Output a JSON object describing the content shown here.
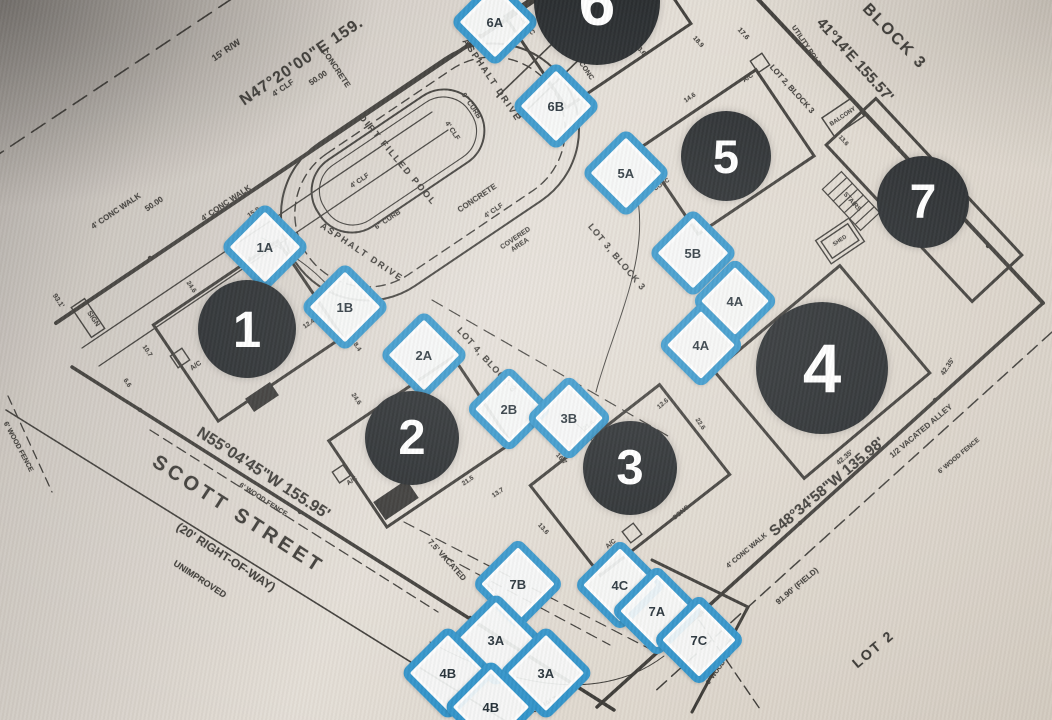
{
  "photo": {
    "colors": {
      "blue": "#2a90c8",
      "circle": "#1b1f22",
      "circle_text": "#ffffff",
      "ink": "#35332f"
    }
  },
  "circles": [
    {
      "label": "1",
      "x": 247,
      "y": 329,
      "r": 49
    },
    {
      "label": "2",
      "x": 412,
      "y": 438,
      "r": 47
    },
    {
      "label": "3",
      "x": 630,
      "y": 468,
      "r": 47
    },
    {
      "label": "4",
      "x": 822,
      "y": 368,
      "r": 66
    },
    {
      "label": "5",
      "x": 726,
      "y": 156,
      "r": 45
    },
    {
      "label": "6",
      "x": 597,
      "y": 2,
      "r": 63
    },
    {
      "label": "7",
      "x": 923,
      "y": 202,
      "r": 46
    }
  ],
  "markers": [
    {
      "label": "1A",
      "x": 258,
      "y": 240,
      "s": 50
    },
    {
      "label": "1B",
      "x": 338,
      "y": 300,
      "s": 50
    },
    {
      "label": "2A",
      "x": 417,
      "y": 348,
      "s": 50
    },
    {
      "label": "2B",
      "x": 502,
      "y": 402,
      "s": 48
    },
    {
      "label": "3B",
      "x": 562,
      "y": 411,
      "s": 48
    },
    {
      "label": "5A",
      "x": 619,
      "y": 166,
      "s": 50
    },
    {
      "label": "5B",
      "x": 686,
      "y": 246,
      "s": 50
    },
    {
      "label": "4A",
      "x": 728,
      "y": 294,
      "s": 48
    },
    {
      "label": "4A",
      "x": 694,
      "y": 338,
      "s": 48
    },
    {
      "label": "6A",
      "x": 488,
      "y": 15,
      "s": 50
    },
    {
      "label": "6B",
      "x": 549,
      "y": 99,
      "s": 50
    },
    {
      "label": "7B",
      "x": 511,
      "y": 577,
      "s": 52
    },
    {
      "label": "4C",
      "x": 613,
      "y": 578,
      "s": 52
    },
    {
      "label": "7A",
      "x": 650,
      "y": 604,
      "s": 52
    },
    {
      "label": "7C",
      "x": 692,
      "y": 633,
      "s": 52
    },
    {
      "label": "3A",
      "x": 489,
      "y": 633,
      "s": 54
    },
    {
      "label": "4B",
      "x": 441,
      "y": 666,
      "s": 54
    },
    {
      "label": "3A",
      "x": 539,
      "y": 666,
      "s": 54
    },
    {
      "label": "4B",
      "x": 484,
      "y": 700,
      "s": 54
    }
  ],
  "labels": {
    "bearings": [
      {
        "name": "bearing-northwest",
        "text": "N47°20'00\"E 159.",
        "x": 302,
        "y": 62,
        "rot": -34,
        "size": 16,
        "b": 1,
        "sp": 1
      },
      {
        "name": "bearing-northeast",
        "text": "41°14'E 155.57'",
        "x": 855,
        "y": 60,
        "rot": 48,
        "size": 15,
        "b": 1
      },
      {
        "name": "bearing-southwest",
        "text": "N55°04'45\"W 155.95'",
        "x": 263,
        "y": 474,
        "rot": 33,
        "size": 16,
        "b": 1
      },
      {
        "name": "bearing-southeast",
        "text": "S48°34'58\"W 135.98'",
        "x": 827,
        "y": 487,
        "rot": -40,
        "size": 15,
        "b": 1
      },
      {
        "name": "field-distance",
        "text": "91.90' (FIELD)",
        "x": 797,
        "y": 586,
        "rot": -40,
        "size": 8
      },
      {
        "name": "right-of-way-note",
        "text": "15' R/W",
        "x": 226,
        "y": 50,
        "rot": -34,
        "size": 9,
        "b": 1
      }
    ],
    "lots": [
      {
        "name": "block3-title",
        "text": "BLOCK 3",
        "x": 894,
        "y": 37,
        "rot": 46,
        "size": 16,
        "b": 1,
        "sp": 2
      },
      {
        "name": "lot2-block3",
        "text": "LOT 2, BLOCK 3",
        "x": 792,
        "y": 89,
        "rot": 48,
        "size": 8
      },
      {
        "name": "lot3-block3",
        "text": "LOT 3, BLOCK 3",
        "x": 617,
        "y": 257,
        "rot": 50,
        "size": 9,
        "sp": 1
      },
      {
        "name": "lot4-block3",
        "text": "LOT 4, BLOCK 3",
        "x": 487,
        "y": 360,
        "rot": 48,
        "size": 9,
        "sp": 1
      },
      {
        "name": "lot2-title",
        "text": "LOT 2",
        "x": 873,
        "y": 649,
        "rot": -40,
        "size": 14,
        "b": 1,
        "sp": 2
      }
    ],
    "street": [
      {
        "name": "street-name",
        "text": "SCOTT STREET",
        "x": 238,
        "y": 515,
        "rot": 33,
        "size": 20,
        "b": 1,
        "sp": 4
      },
      {
        "name": "street-right-of-way",
        "text": "(20' RIGHT-OF-WAY)",
        "x": 226,
        "y": 557,
        "rot": 33,
        "size": 12
      },
      {
        "name": "street-unimproved",
        "text": "UNIMPROVED",
        "x": 200,
        "y": 579,
        "rot": 33,
        "size": 9
      }
    ],
    "alleys": [
      {
        "name": "half-vacated-alley",
        "text": "1/2 VACATED ALLEY",
        "x": 921,
        "y": 431,
        "rot": -40,
        "size": 8
      },
      {
        "name": "vacated-alley",
        "text": "7.5' VACATED",
        "x": 447,
        "y": 560,
        "rot": 48,
        "size": 8
      },
      {
        "name": "utility-alley",
        "text": "UTILITY ALLEY",
        "x": 501,
        "y": 603,
        "rot": 48,
        "size": 8
      }
    ],
    "features": [
      {
        "name": "pool-label",
        "text": "DIRT FILLED POOL",
        "x": 398,
        "y": 160,
        "rot": 50,
        "size": 9,
        "sp": 2
      },
      {
        "name": "asphalt-drive-top",
        "text": "ASPHALT DRIVE",
        "x": 492,
        "y": 80,
        "rot": 56,
        "size": 9,
        "sp": 2
      },
      {
        "name": "asphalt-drive-mid",
        "text": "ASPHALT DRIVE",
        "x": 362,
        "y": 252,
        "rot": 34,
        "size": 9,
        "sp": 2
      },
      {
        "name": "asphalt-bottom",
        "text": "ASPHALT",
        "x": 543,
        "y": 706,
        "rot": -28,
        "size": 7
      },
      {
        "name": "concrete-top",
        "text": "CONCRETE",
        "x": 336,
        "y": 68,
        "rot": 56,
        "size": 8
      },
      {
        "name": "concrete-mid",
        "text": "CONCRETE",
        "x": 477,
        "y": 198,
        "rot": -34,
        "size": 8
      },
      {
        "name": "covered-area",
        "text": "COVERED AREA",
        "x": 518,
        "y": 242,
        "rot": -34,
        "size": 7,
        "wrap": 42
      },
      {
        "name": "walk-label-1",
        "text": "4' CONC WALK",
        "x": 116,
        "y": 211,
        "rot": -34,
        "size": 8
      },
      {
        "name": "walk-label-2",
        "text": "4' CONC WALK",
        "x": 226,
        "y": 203,
        "rot": -34,
        "size": 8
      },
      {
        "name": "walk-label-3",
        "text": "4' CONC WALK",
        "x": 747,
        "y": 551,
        "rot": -40,
        "size": 7
      },
      {
        "name": "curb-label-1",
        "text": "6\" CURB",
        "x": 471,
        "y": 106,
        "rot": 56,
        "size": 7
      },
      {
        "name": "curb-label-2",
        "text": "6\" CURB",
        "x": 388,
        "y": 220,
        "rot": -34,
        "size": 7
      },
      {
        "name": "clf-label-1",
        "text": "4' CLF",
        "x": 283,
        "y": 88,
        "rot": -34,
        "size": 8
      },
      {
        "name": "clf-label-2",
        "text": "4' CLF",
        "x": 452,
        "y": 131,
        "rot": 56,
        "size": 7
      },
      {
        "name": "clf-label-3",
        "text": "4' CLF",
        "x": 360,
        "y": 181,
        "rot": -34,
        "size": 7
      },
      {
        "name": "clf-label-4",
        "text": "4' CLF",
        "x": 494,
        "y": 211,
        "rot": -34,
        "size": 7
      },
      {
        "name": "conc-label-1",
        "text": "CONC",
        "x": 527,
        "y": 26,
        "rot": 56,
        "size": 7
      },
      {
        "name": "conc-label-2",
        "text": "CONC",
        "x": 586,
        "y": 71,
        "rot": 56,
        "size": 7
      },
      {
        "name": "conc-label-3",
        "text": "CONC",
        "x": 662,
        "y": 185,
        "rot": -34,
        "size": 6
      },
      {
        "name": "conc-label-4",
        "text": "CONC",
        "x": 681,
        "y": 513,
        "rot": -40,
        "size": 6.5
      },
      {
        "name": "utility-pole",
        "text": "UTILITY POLE",
        "x": 806,
        "y": 46,
        "rot": 56,
        "size": 7
      },
      {
        "name": "ac-label-1",
        "text": "A/C",
        "x": 196,
        "y": 366,
        "rot": -34,
        "size": 7
      },
      {
        "name": "ac-label-2",
        "text": "A/C",
        "x": 748,
        "y": 78,
        "rot": -34,
        "size": 6.5
      },
      {
        "name": "ac-label-3",
        "text": "A/C",
        "x": 611,
        "y": 544,
        "rot": -40,
        "size": 6.5
      },
      {
        "name": "ac-label-4",
        "text": "A/C",
        "x": 352,
        "y": 481,
        "rot": -34,
        "size": 6.5
      },
      {
        "name": "sign-label",
        "text": "SIGN",
        "x": 93,
        "y": 319,
        "rot": 56,
        "size": 7
      },
      {
        "name": "balcony-label",
        "text": "BALCONY",
        "x": 843,
        "y": 117,
        "rot": -34,
        "size": 6
      },
      {
        "name": "stairs-label",
        "text": "STAIRS",
        "x": 852,
        "y": 202,
        "rot": 48,
        "size": 6.5
      },
      {
        "name": "shed-label",
        "text": "SHED",
        "x": 840,
        "y": 241,
        "rot": -34,
        "size": 5.5
      },
      {
        "name": "wood-fence-se",
        "text": "6' WOOD FENCE",
        "x": 959,
        "y": 456,
        "rot": -40,
        "size": 6.5
      },
      {
        "name": "wood-fence-s",
        "text": "6' WOOD FENCE",
        "x": 723,
        "y": 663,
        "rot": -54,
        "size": 6.5
      },
      {
        "name": "wood-fence-sw",
        "text": "6' WOOD FENCE",
        "x": 263,
        "y": 500,
        "rot": 33,
        "size": 7
      },
      {
        "name": "wood-fence-w",
        "text": "6' WOOD FENCE",
        "x": 18,
        "y": 447,
        "rot": 62,
        "size": 7
      }
    ],
    "dims": [
      {
        "name": "dim-label",
        "text": "50.00",
        "x": 318,
        "y": 78,
        "rot": -34,
        "size": 8
      },
      {
        "name": "dim-label",
        "text": "50.00",
        "x": 154,
        "y": 204,
        "rot": -34,
        "size": 8
      },
      {
        "name": "dim-label",
        "text": "15.9",
        "x": 254,
        "y": 213,
        "rot": -34,
        "size": 7
      },
      {
        "name": "dim-label",
        "text": "93.1'",
        "x": 58,
        "y": 301,
        "rot": 56,
        "size": 7
      },
      {
        "name": "dim-label",
        "text": "17.6",
        "x": 743,
        "y": 34,
        "rot": 48,
        "size": 7
      },
      {
        "name": "dim-label",
        "text": "13.6",
        "x": 843,
        "y": 141,
        "rot": 48,
        "size": 6
      },
      {
        "name": "dim-label",
        "text": "42.35'",
        "x": 845,
        "y": 458,
        "rot": -40,
        "size": 7
      },
      {
        "name": "dim-label",
        "text": "42.35'",
        "x": 948,
        "y": 367,
        "rot": -56,
        "size": 7
      },
      {
        "name": "dim-label",
        "text": "21.4",
        "x": 246,
        "y": 262,
        "rot": -34,
        "size": 6.5
      },
      {
        "name": "dim-label",
        "text": "24.6",
        "x": 191,
        "y": 287,
        "rot": 56,
        "size": 6.5
      },
      {
        "name": "dim-label",
        "text": "12.4",
        "x": 309,
        "y": 324,
        "rot": -34,
        "size": 6.5
      },
      {
        "name": "dim-label",
        "text": "8.4",
        "x": 357,
        "y": 347,
        "rot": 56,
        "size": 6.5
      },
      {
        "name": "dim-label",
        "text": "10.7",
        "x": 147,
        "y": 351,
        "rot": 56,
        "size": 6.5
      },
      {
        "name": "dim-label",
        "text": "6.6",
        "x": 127,
        "y": 383,
        "rot": 56,
        "size": 6.5
      },
      {
        "name": "dim-label",
        "text": "24.6",
        "x": 356,
        "y": 399,
        "rot": 56,
        "size": 6.5
      },
      {
        "name": "dim-label",
        "text": "21.5",
        "x": 468,
        "y": 481,
        "rot": -34,
        "size": 6.5
      },
      {
        "name": "dim-label",
        "text": "13.7",
        "x": 498,
        "y": 493,
        "rot": -34,
        "size": 6.5
      },
      {
        "name": "dim-label",
        "text": "21.6",
        "x": 589,
        "y": 426,
        "rot": -34,
        "size": 6.5
      },
      {
        "name": "dim-label",
        "text": "12.9",
        "x": 603,
        "y": 446,
        "rot": 48,
        "size": 6.5
      },
      {
        "name": "dim-label",
        "text": "16.7",
        "x": 561,
        "y": 459,
        "rot": 48,
        "size": 6.5
      },
      {
        "name": "dim-label",
        "text": "13.6",
        "x": 543,
        "y": 529,
        "rot": 48,
        "size": 6.5
      },
      {
        "name": "dim-label",
        "text": "23.6",
        "x": 640,
        "y": 50,
        "rot": 48,
        "size": 6.5
      },
      {
        "name": "dim-label",
        "text": "18.9",
        "x": 698,
        "y": 42,
        "rot": 48,
        "size": 6.5
      },
      {
        "name": "dim-label",
        "text": "13.4",
        "x": 590,
        "y": 57,
        "rot": -34,
        "size": 6.5
      },
      {
        "name": "dim-label",
        "text": "14.6",
        "x": 690,
        "y": 98,
        "rot": -34,
        "size": 6.5
      },
      {
        "name": "dim-label",
        "text": "20.6",
        "x": 831,
        "y": 359,
        "rot": -40,
        "size": 6.5
      },
      {
        "name": "dim-label",
        "text": "22.6",
        "x": 700,
        "y": 424,
        "rot": 56,
        "size": 6.5
      },
      {
        "name": "dim-label",
        "text": "12.6",
        "x": 663,
        "y": 404,
        "rot": -40,
        "size": 6.5
      },
      {
        "name": "dim-label",
        "text": "21.4",
        "x": 546,
        "y": 10,
        "rot": -34,
        "size": 6.5
      }
    ]
  }
}
